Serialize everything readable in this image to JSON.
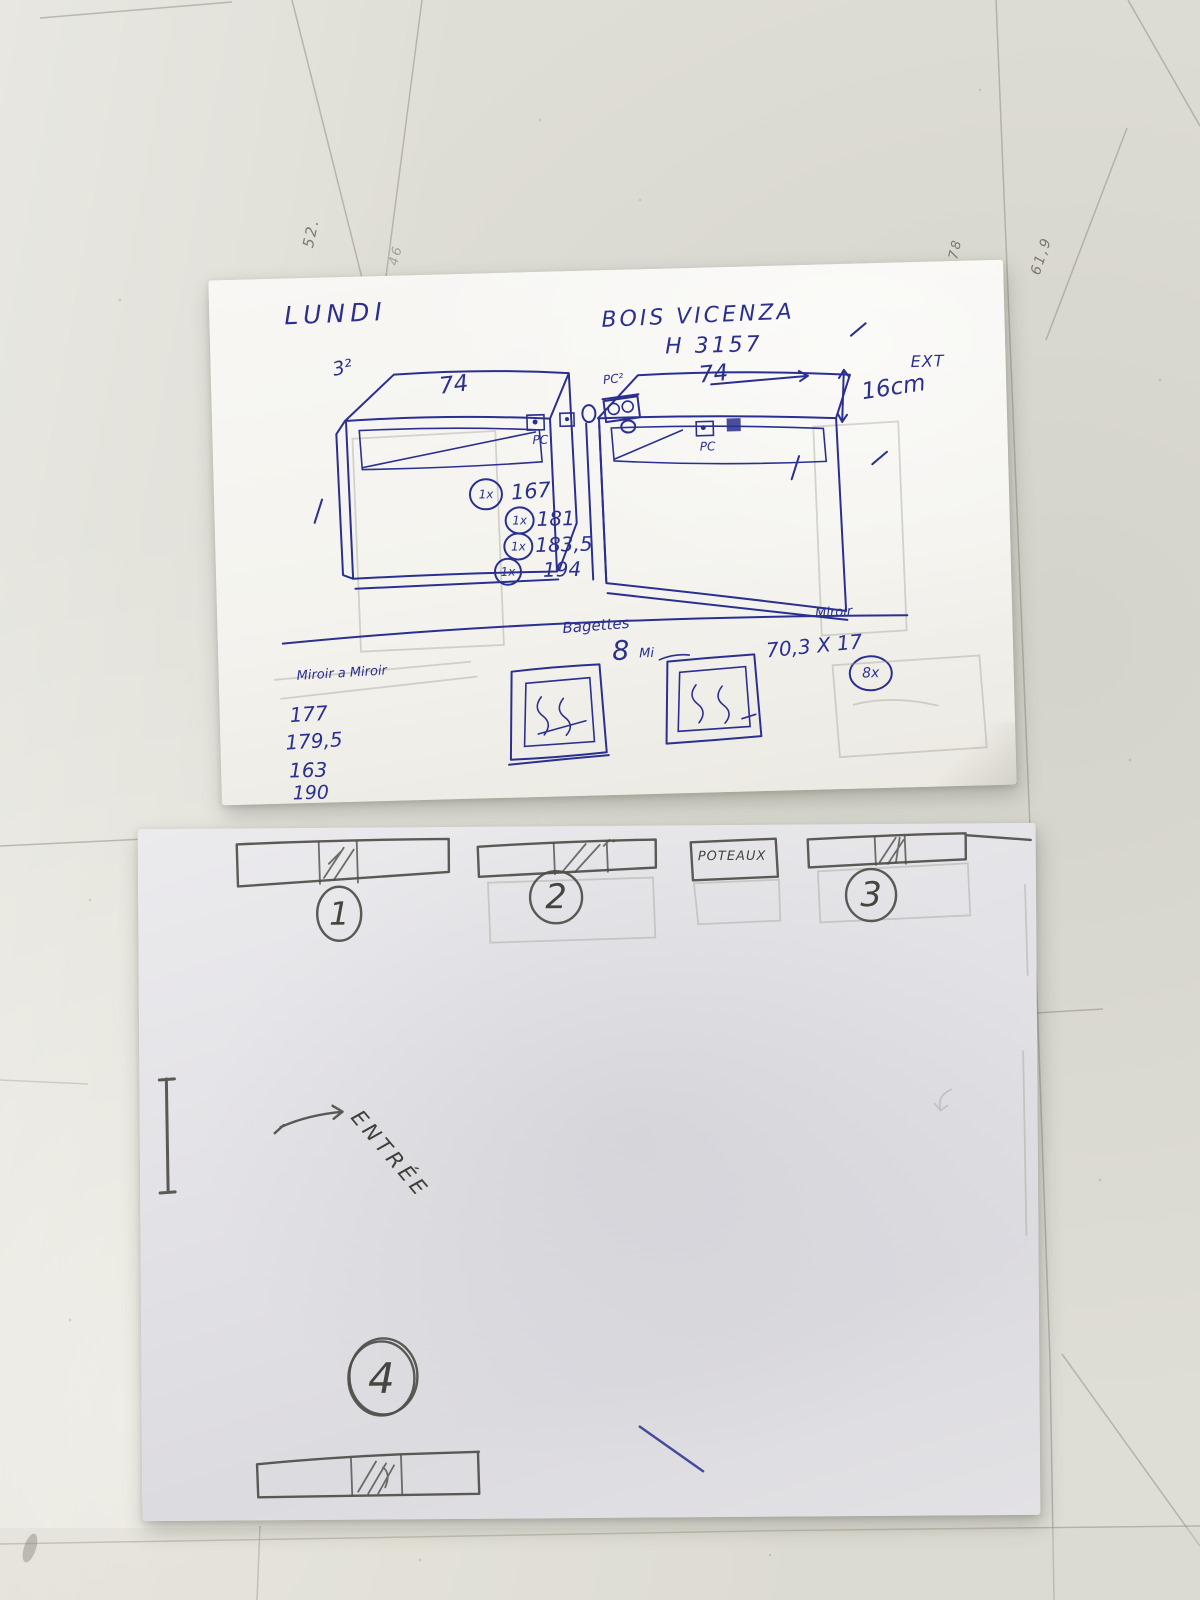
{
  "floor": {
    "markings": [
      {
        "text": "52."
      },
      {
        "text": "46"
      },
      {
        "text": "INT 78"
      },
      {
        "text": "61,9"
      }
    ]
  },
  "sketch_sheet": {
    "day": "LUNDI",
    "material": "BOIS VICENZA",
    "reference": "H 3157",
    "left_corner_note": "3²",
    "left_unit_width": "74",
    "right_unit_width": "74",
    "left_compartment": "PC",
    "right_compartment": "PC",
    "junction": "PC²",
    "depth_label": "EXT",
    "depth_value": "16cm",
    "cut_list": [
      {
        "qty": "1x",
        "value": "167"
      },
      {
        "qty": "1x",
        "value": "181"
      },
      {
        "qty": "1x",
        "value": "183,5"
      },
      {
        "qty": "1x",
        "value": "194"
      }
    ],
    "baguettes_label": "Bagettes",
    "mirror_note_qty": "8",
    "mirror_note_word": "Mi",
    "mirror_header": "Miroir",
    "mirror_dimensions": "70,3 X 17",
    "mirror_qty": "8x",
    "mirror_list_title": "Miroir a Miroir",
    "mirror_list": [
      "177",
      "179,5",
      "163",
      "190"
    ]
  },
  "plan_sheet": {
    "zones": [
      "1",
      "2",
      "3",
      "4"
    ],
    "pillar_label": "POTEAUX",
    "entrance_label": "ENTRÉE"
  },
  "colors": {
    "pen": "#2b3090",
    "pencil": "#4e4d47",
    "floor": "#dfded6",
    "paper_top": "#f5f4f0",
    "paper_plan": "#e3e2e6"
  }
}
